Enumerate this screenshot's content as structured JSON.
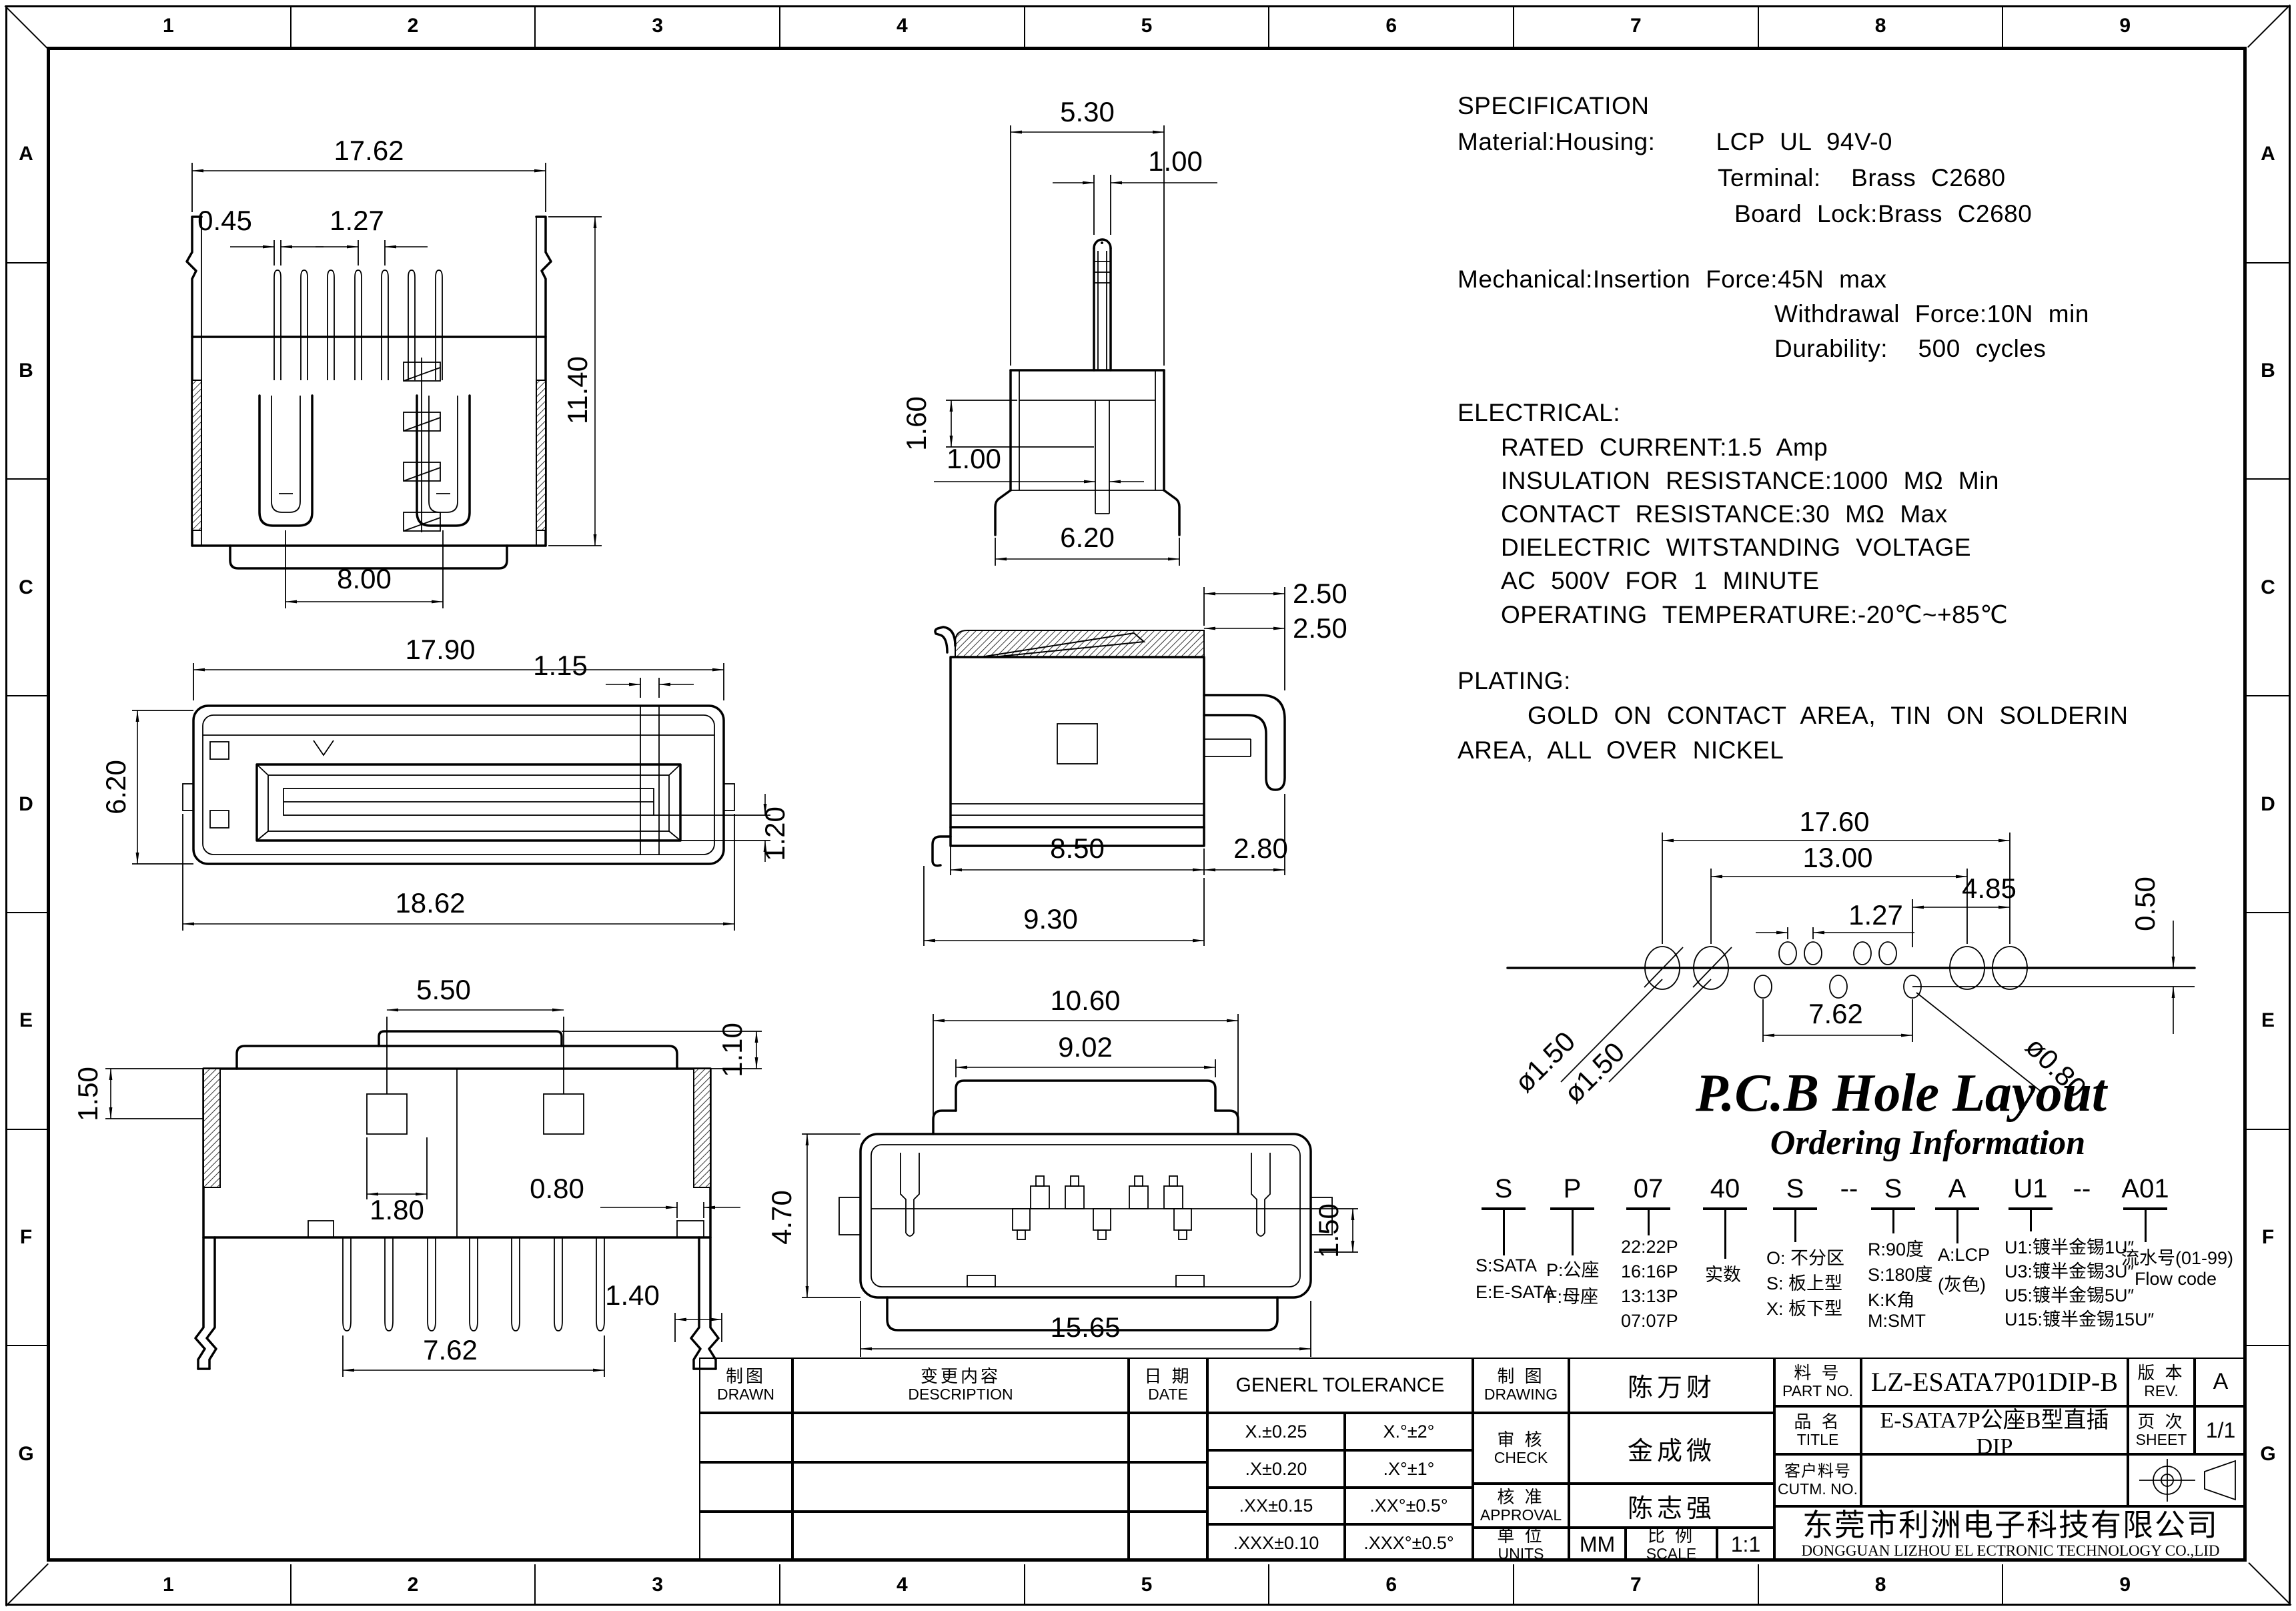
{
  "sheet": {
    "cols": [
      "1",
      "2",
      "3",
      "4",
      "5",
      "6",
      "7",
      "8",
      "9"
    ],
    "rows": [
      "A",
      "B",
      "C",
      "D",
      "E",
      "F",
      "G"
    ]
  },
  "notes": {
    "spec": [
      "SPECIFICATION",
      "Material:Housing:    LCP UL 94V-0",
      "Terminal:  Brass C2680",
      "Board Lock:Brass C2680",
      "Mechanical:Insertion Force:45N max",
      "Withdrawal Force:10N min",
      "Durability:  500 cycles"
    ],
    "electrical": [
      "ELECTRICAL:",
      "RATED CURRENT:1.5 Amp",
      "INSULATION RESISTANCE:1000 MΩ Min",
      "CONTACT RESISTANCE:30 MΩ Max",
      "DIELECTRIC WITSTANDING VOLTAGE",
      "AC 500V FOR 1 MINUTE",
      "OPERATING TEMPERATURE:-20℃~+85℃"
    ],
    "plating": [
      "PLATING:",
      "GOLD ON CONTACT AREA, TIN ON SOLDERIN",
      "AREA, ALL OVER NICKEL"
    ]
  },
  "pcb": {
    "title": "P.C.B Hole Layout",
    "subtitle": "Ordering Information",
    "dims": {
      "span": "17.60",
      "inner_span": "13.00",
      "side": "4.85",
      "pitch": "1.27",
      "row_offset": "0.50",
      "center_pitch": "7.62",
      "hole_left_1": "ø1.50",
      "hole_left_2": "ø1.50",
      "hole_small": "ø0.80"
    }
  },
  "ordering": {
    "cols": [
      {
        "code": "S",
        "items": [
          "S:SATA",
          "E:E-SATA"
        ]
      },
      {
        "code": "P",
        "items": [
          "P:公座",
          "F:母座"
        ]
      },
      {
        "code": "07",
        "items": [
          "22:22P",
          "16:16P",
          "13:13P",
          "07:07P"
        ]
      },
      {
        "code": "40",
        "items": [
          "实数"
        ]
      },
      {
        "code": "S",
        "items": [
          "O: 不分区",
          "S: 板上型",
          "X: 板下型"
        ]
      },
      {
        "code": "--",
        "items": []
      },
      {
        "code": "S",
        "items": [
          "R:90度",
          "S:180度",
          "K:K角",
          "M:SMT"
        ]
      },
      {
        "code": "A",
        "items": [
          "A:LCP",
          "(灰色)"
        ]
      },
      {
        "code": "U1",
        "items": [
          "U1:镀半金锡1U″",
          "U3:镀半金锡3U″",
          "U5:镀半金锡5U″",
          "U15:镀半金锡15U″"
        ]
      },
      {
        "code": "--",
        "items": []
      },
      {
        "code": "A01",
        "items": [
          "流水号(01-99)",
          "Flow code"
        ]
      }
    ]
  },
  "views": {
    "front": {
      "width": "17.62",
      "pin_width": "0.45",
      "pitch": "1.27",
      "height": "11.40",
      "contact_span": "8.00"
    },
    "top": {
      "width": "17.90",
      "tab": "1.15",
      "depth": "6.20",
      "overall": "18.62",
      "step": "1.20"
    },
    "back": {
      "tab": "5.50",
      "lead_in": "1.50",
      "cap": "1.10",
      "inner": "1.80",
      "pin": "0.80",
      "pitch": "7.62",
      "lock": "1.40"
    },
    "pin_side": {
      "width": "5.30",
      "pin": "1.00",
      "depth": "1.60",
      "pin_lower": "1.00",
      "base": "6.20"
    },
    "side": {
      "top_1": "2.50",
      "top_2": "2.50",
      "body": "8.50",
      "back": "2.80",
      "overall": "9.30"
    },
    "bottom": {
      "shoulder": "10.60",
      "cap": "9.02",
      "height": "4.70",
      "lead": "1.50",
      "overall": "15.65"
    }
  },
  "titleblock": {
    "drawn": {
      "zh": "制图",
      "en": "DRAWN"
    },
    "description": {
      "zh": "变更内容",
      "en": "DESCRIPTION"
    },
    "date": {
      "zh": "日 期",
      "en": "DATE"
    },
    "tolerance": {
      "title": "GENERL TOLERANCE",
      "rows": [
        [
          "X.±0.25",
          "X.°±2°"
        ],
        [
          ".X±0.20",
          ".X°±1°"
        ],
        [
          ".XX±0.15",
          ".XX°±0.5°"
        ],
        [
          ".XXX±0.10",
          ".XXX°±0.5°"
        ]
      ]
    },
    "drawing": {
      "zh": "制 图",
      "en": "DRAWING",
      "value": "陈万财"
    },
    "check": {
      "zh": "审 核",
      "en": "CHECK",
      "value": "金成微"
    },
    "approval": {
      "zh": "核 准",
      "en": "APPROVAL",
      "value": "陈志强"
    },
    "units": {
      "zh": "单 位",
      "en": "UNITS",
      "value": "MM"
    },
    "scale": {
      "zh": "比 例",
      "en": "SCALE",
      "value": "1:1"
    },
    "part_no": {
      "zh": "料 号",
      "en": "PART NO.",
      "value": "LZ-ESATA7P01DIP-B"
    },
    "rev": {
      "zh": "版 本",
      "en": "REV.",
      "value": "A"
    },
    "title": {
      "zh": "品 名",
      "en": "TITLE",
      "value": "E-SATA7P公座B型直插DIP"
    },
    "sheet_no": {
      "zh": "页 次",
      "en": "SHEET",
      "value": "1/1"
    },
    "customer": {
      "zh": "客户料号",
      "en": "CUTM. NO.",
      "value": ""
    },
    "company": {
      "zh": "东莞市利洲电子科技有限公司",
      "en": "DONGGUAN LIZHOU EL ECTRONIC TECHNOLOGY CO.,LID"
    }
  }
}
